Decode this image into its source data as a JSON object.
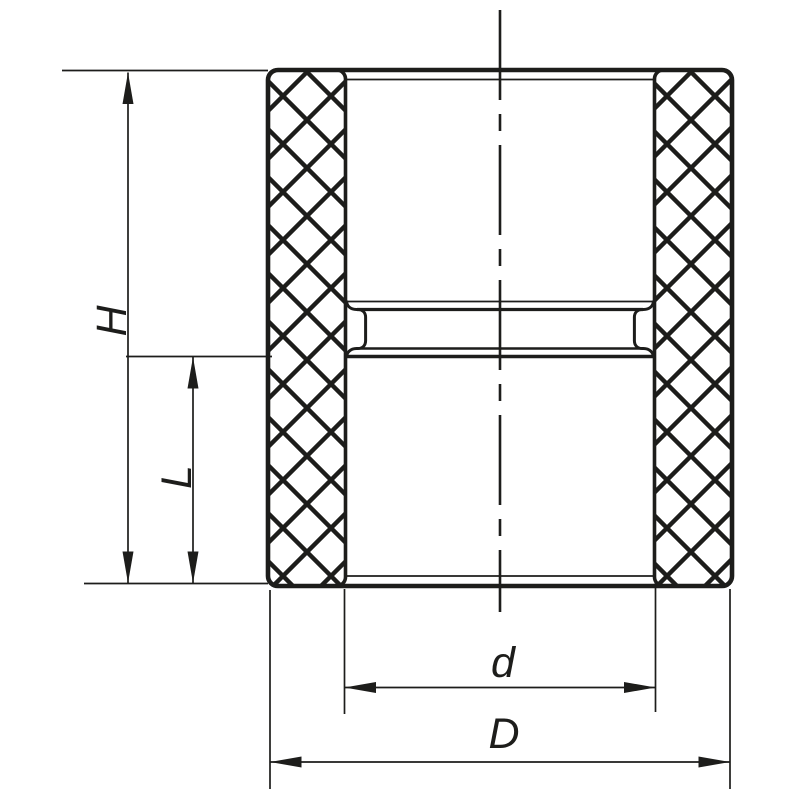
{
  "labels": {
    "total_height": "H",
    "socket_depth": "L",
    "socket_inner_diameter": "d",
    "outer_diameter": "D"
  },
  "colors": {
    "line": "#1d1d1b",
    "background": "#ffffff"
  }
}
